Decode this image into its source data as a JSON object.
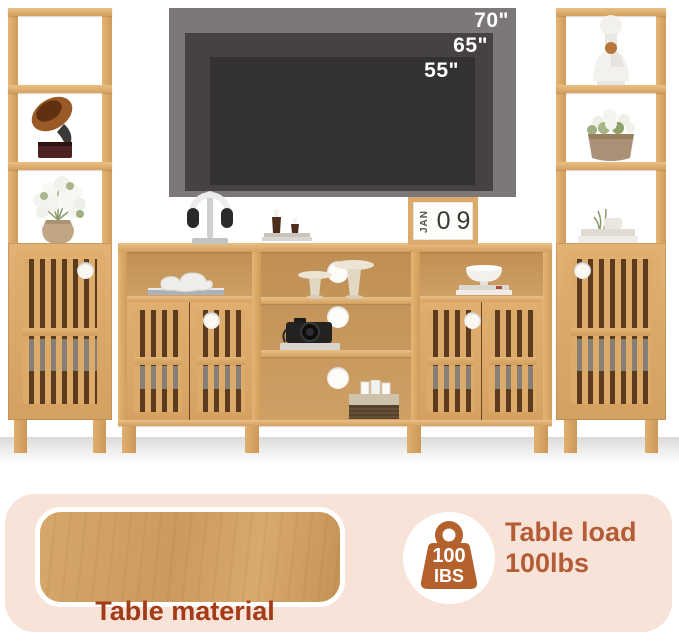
{
  "tv": {
    "sizes": [
      "70\"",
      "65\"",
      "55\""
    ]
  },
  "calendar": {
    "month": "JAN",
    "day_digits": [
      "0",
      "9"
    ]
  },
  "banner": {
    "material_label": "Table material",
    "load_line1": "Table load",
    "load_line2": "100lbs",
    "badge_value": "100",
    "badge_unit": "IBS"
  },
  "colors": {
    "wood": "#dcab6c",
    "wood_dark_gap": "#5b3a1d",
    "banner_bg": "#f7e3d7",
    "material_label_text": "#a33a18",
    "load_text": "#b35c35",
    "weight_icon": "#b5612e",
    "tv_70": "#7b7877",
    "tv_65": "#454241",
    "tv_55": "#343230"
  },
  "decor": {
    "left_tower": [
      "gramophone",
      "white-flower-vase"
    ],
    "right_tower": [
      "bust-statue",
      "potted-plant",
      "book-stack-with-plant"
    ],
    "console_top": [
      "headphones-on-stand",
      "candle-holders-on-books",
      "desk-calendar"
    ],
    "console_shelves": [
      "abstract-sculpture-on-book",
      "pedestal-stands",
      "retro-camera-on-book",
      "storage-basket-with-cards",
      "white-bowl-on-books"
    ]
  }
}
